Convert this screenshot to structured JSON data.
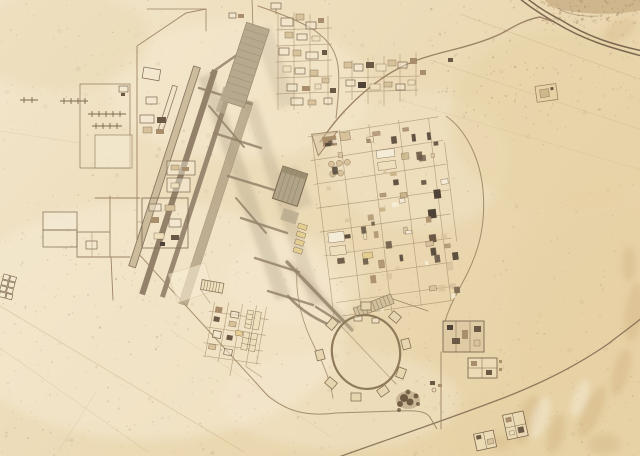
{
  "scene": {
    "type": "satellite-aerial-photo",
    "description": "Overhead satellite view of a desert air base: two parallel diagonal runways with taxiways, a large northern apron, a gridded cantonment of buildings to the east, an antenna farm to the west, a circular dispersal loop with hardstands to the southeast, walled compounds, a divided highway crossing the upper-right desert, and faint tracks over pale sand with dunes at lower right.",
    "terrain": "desert sand",
    "features": [
      "runway-complex",
      "parallel-taxiway",
      "north-apron",
      "central-hangar",
      "east-cantonment-grid",
      "north-cantonment",
      "antenna-farm",
      "west-compound",
      "dispersal-loop",
      "hardstand-pads",
      "south-support-compound",
      "east-walled-compounds",
      "divided-highway",
      "base-access-road",
      "perimeter-road",
      "south-road",
      "desert-tracks",
      "sand-dunes",
      "small-walled-compounds",
      "ne-square-compound"
    ],
    "no_visible_text": true
  },
  "palette": {
    "sand_base": "#eddcb9",
    "sand_light": "#f6ecd3",
    "sand_gold": "#e6d1a4",
    "sand_dune": "#cfb07e",
    "road_dark": "#7c6850",
    "road_mid": "#9c8465",
    "road_faint": "#c7ae85",
    "street": "#a8916d",
    "runway_light": "#cdbc9c",
    "runway_edge": "#8b7962",
    "runway_dark": "#93816a",
    "runway_dark2": "#9a8870",
    "taxiway_fill": "#b2a184",
    "taxiway_line": "#94826a",
    "apron": "#b6a98d",
    "apron_rib": "#a1937a",
    "hangar": "#b0a387",
    "hangar_line": "#8f8165",
    "bldg_outline": "#7d6950",
    "bldg_cream": "#eee0bd",
    "bldg_tan": "#d7c29c",
    "bldg_brown": "#a98e6c",
    "bldg_dark": "#6b5946",
    "bldg_deep": "#4e4336",
    "bldg_pale": "#f4ecd6",
    "bldg_yellow": "#e3cd90",
    "shadow": "#7e6c55",
    "blob_dark": "#5f4a33",
    "patch_brown": "#b08d62",
    "speckles": [
      "#a8906a",
      "#97805e",
      "#887150",
      "#b49a72"
    ],
    "buildings": [
      "#eee0bd",
      "#d7c29c",
      "#a98e6c",
      "#6b5946",
      "#55483a",
      "#f4ecd6",
      "#c9b489"
    ]
  }
}
